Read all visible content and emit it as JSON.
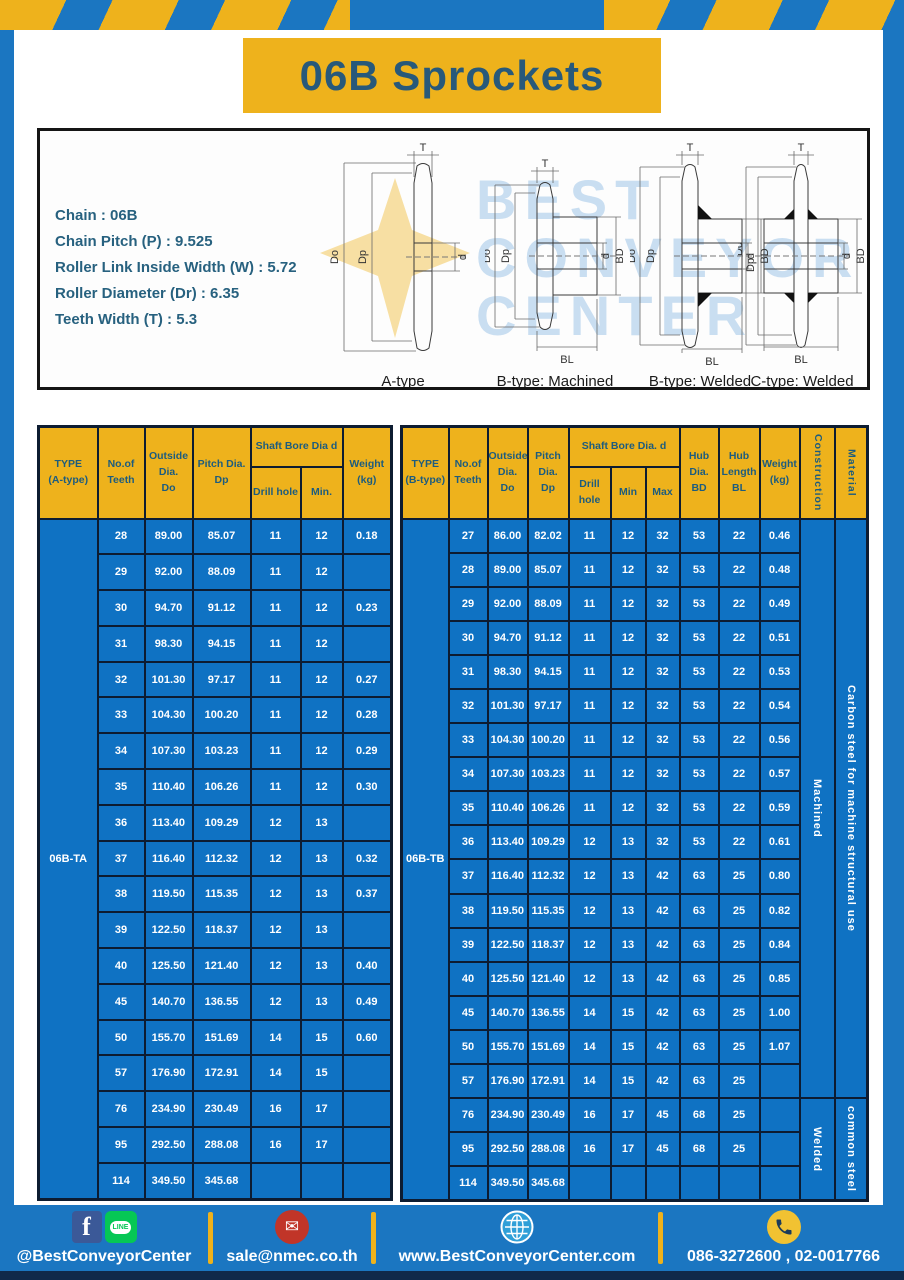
{
  "title": "06B Sprockets",
  "specs": {
    "lines": [
      "Chain  : 06B",
      "Chain Pitch (P)  :  9.525",
      "Roller Link Inside Width (W)  :  5.72",
      "Roller Diameter (Dr)  : 6.35",
      "Teeth Width (T)  :  5.3"
    ]
  },
  "watermark": {
    "lines": [
      "BEST",
      "CONVEYOR",
      "CENTER"
    ]
  },
  "diagrams": {
    "captions": [
      "A-type",
      "B-type: Machined",
      "B-type: Welded",
      "C-type: Welded"
    ],
    "dims": {
      "t": "T",
      "outside": "Do",
      "pitch": "Dp",
      "bore": "d",
      "hub_dia": "BD",
      "hub_len": "BL"
    }
  },
  "table_a": {
    "header": {
      "type": "TYPE\n(A-type)",
      "teeth": "No.of\nTeeth",
      "outside": "Outside\nDia.\nDo",
      "pitch": "Pitch Dia.\nDp",
      "shaft_bore": "Shaft Bore Dia d",
      "drill": "Drill hole",
      "min": "Min.",
      "weight": "Weight\n(kg)"
    },
    "type_label": "06B-TA",
    "rows": [
      [
        "28",
        "89.00",
        "85.07",
        "11",
        "12",
        "0.18"
      ],
      [
        "29",
        "92.00",
        "88.09",
        "11",
        "12",
        ""
      ],
      [
        "30",
        "94.70",
        "91.12",
        "11",
        "12",
        "0.23"
      ],
      [
        "31",
        "98.30",
        "94.15",
        "11",
        "12",
        ""
      ],
      [
        "32",
        "101.30",
        "97.17",
        "11",
        "12",
        "0.27"
      ],
      [
        "33",
        "104.30",
        "100.20",
        "11",
        "12",
        "0.28"
      ],
      [
        "34",
        "107.30",
        "103.23",
        "11",
        "12",
        "0.29"
      ],
      [
        "35",
        "110.40",
        "106.26",
        "11",
        "12",
        "0.30"
      ],
      [
        "36",
        "113.40",
        "109.29",
        "12",
        "13",
        ""
      ],
      [
        "37",
        "116.40",
        "112.32",
        "12",
        "13",
        "0.32"
      ],
      [
        "38",
        "119.50",
        "115.35",
        "12",
        "13",
        "0.37"
      ],
      [
        "39",
        "122.50",
        "118.37",
        "12",
        "13",
        ""
      ],
      [
        "40",
        "125.50",
        "121.40",
        "12",
        "13",
        "0.40"
      ],
      [
        "45",
        "140.70",
        "136.55",
        "12",
        "13",
        "0.49"
      ],
      [
        "50",
        "155.70",
        "151.69",
        "14",
        "15",
        "0.60"
      ],
      [
        "57",
        "176.90",
        "172.91",
        "14",
        "15",
        ""
      ],
      [
        "76",
        "234.90",
        "230.49",
        "16",
        "17",
        ""
      ],
      [
        "95",
        "292.50",
        "288.08",
        "16",
        "17",
        ""
      ],
      [
        "114",
        "349.50",
        "345.68",
        "",
        "",
        ""
      ]
    ]
  },
  "table_b": {
    "header": {
      "type": "TYPE\n(B-type)",
      "teeth": "No.of\nTeeth",
      "outside": "Outside\nDia.\nDo",
      "pitch": "Pitch\nDia.\nDp",
      "shaft_bore": "Shaft Bore Dia.  d",
      "drill": "Drill hole",
      "min": "Min",
      "max": "Max",
      "hub_dia": "Hub\nDia.\nBD",
      "hub_len": "Hub\nLength\nBL",
      "weight": "Weight\n(kg)",
      "construction": "Construction",
      "material": "Material"
    },
    "type_label": "06B-TB",
    "rows": [
      [
        "27",
        "86.00",
        "82.02",
        "11",
        "12",
        "32",
        "53",
        "22",
        "0.46"
      ],
      [
        "28",
        "89.00",
        "85.07",
        "11",
        "12",
        "32",
        "53",
        "22",
        "0.48"
      ],
      [
        "29",
        "92.00",
        "88.09",
        "11",
        "12",
        "32",
        "53",
        "22",
        "0.49"
      ],
      [
        "30",
        "94.70",
        "91.12",
        "11",
        "12",
        "32",
        "53",
        "22",
        "0.51"
      ],
      [
        "31",
        "98.30",
        "94.15",
        "11",
        "12",
        "32",
        "53",
        "22",
        "0.53"
      ],
      [
        "32",
        "101.30",
        "97.17",
        "11",
        "12",
        "32",
        "53",
        "22",
        "0.54"
      ],
      [
        "33",
        "104.30",
        "100.20",
        "11",
        "12",
        "32",
        "53",
        "22",
        "0.56"
      ],
      [
        "34",
        "107.30",
        "103.23",
        "11",
        "12",
        "32",
        "53",
        "22",
        "0.57"
      ],
      [
        "35",
        "110.40",
        "106.26",
        "11",
        "12",
        "32",
        "53",
        "22",
        "0.59"
      ],
      [
        "36",
        "113.40",
        "109.29",
        "12",
        "13",
        "32",
        "53",
        "22",
        "0.61"
      ],
      [
        "37",
        "116.40",
        "112.32",
        "12",
        "13",
        "42",
        "63",
        "25",
        "0.80"
      ],
      [
        "38",
        "119.50",
        "115.35",
        "12",
        "13",
        "42",
        "63",
        "25",
        "0.82"
      ],
      [
        "39",
        "122.50",
        "118.37",
        "12",
        "13",
        "42",
        "63",
        "25",
        "0.84"
      ],
      [
        "40",
        "125.50",
        "121.40",
        "12",
        "13",
        "42",
        "63",
        "25",
        "0.85"
      ],
      [
        "45",
        "140.70",
        "136.55",
        "14",
        "15",
        "42",
        "63",
        "25",
        "1.00"
      ],
      [
        "50",
        "155.70",
        "151.69",
        "14",
        "15",
        "42",
        "63",
        "25",
        "1.07"
      ],
      [
        "57",
        "176.90",
        "172.91",
        "14",
        "15",
        "42",
        "63",
        "25",
        ""
      ],
      [
        "76",
        "234.90",
        "230.49",
        "16",
        "17",
        "45",
        "68",
        "25",
        ""
      ],
      [
        "95",
        "292.50",
        "288.08",
        "16",
        "17",
        "45",
        "68",
        "25",
        ""
      ],
      [
        "114",
        "349.50",
        "345.68",
        "",
        "",
        "",
        "",
        "",
        ""
      ]
    ],
    "construction": [
      {
        "label": "Machined",
        "span": 17
      },
      {
        "label": "Welded",
        "span": 3
      }
    ],
    "material": [
      {
        "label": "Carbon steel for machine structural use",
        "span": 17
      },
      {
        "label": "common steel",
        "span": 3
      }
    ]
  },
  "footer": {
    "social": "@BestConveyorCenter",
    "email": "sale@nmec.co.th",
    "website": "www.BestConveyorCenter.com",
    "phone": "086-3272600 , 02-0017766",
    "facebook_label": "f",
    "line_label": "LINE"
  },
  "colors": {
    "frame_blue": "#1b76c1",
    "accent_yellow": "#eeb21c",
    "table_cell_blue": "#0f72c3",
    "table_border": "#0d1c31",
    "header_text": "#1d5c7e",
    "title_text": "#28597a",
    "footer_dark": "#10294a"
  }
}
